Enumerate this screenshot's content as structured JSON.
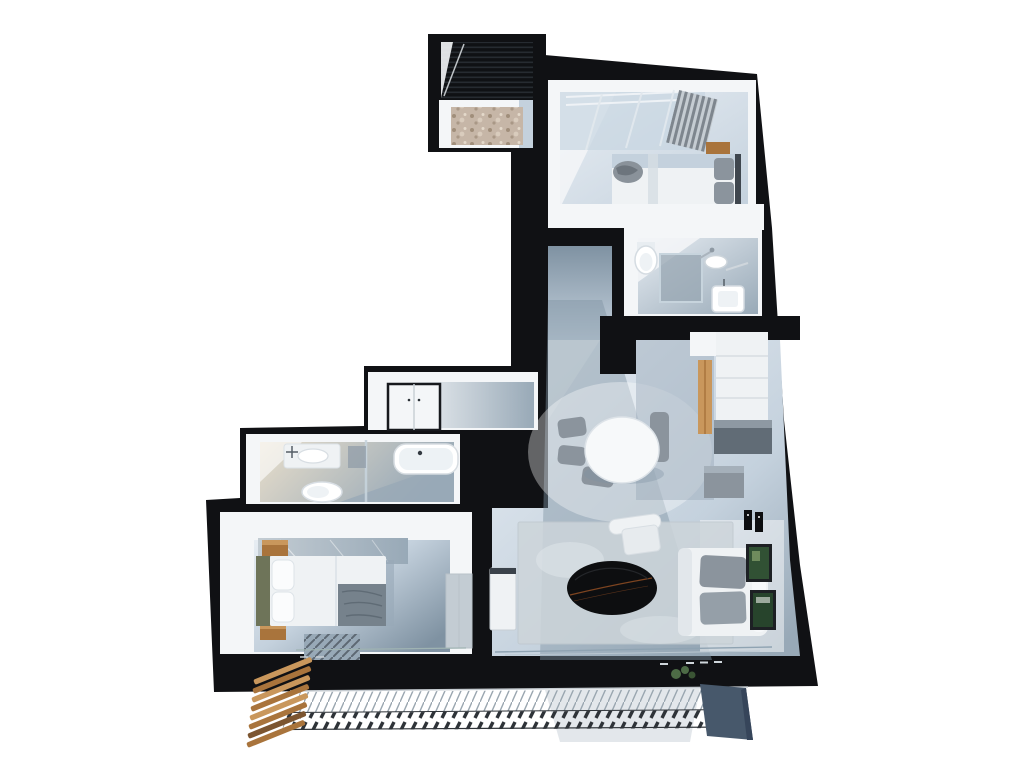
{
  "scene": {
    "type": "3d-floor-plan-render",
    "view": "top-down-isometric-apartment",
    "background": "#ffffff"
  },
  "colors": {
    "page": "#ffffff",
    "wall": "#101114",
    "wall_face": "#f4f6f8",
    "floor_light": "#e7edf3",
    "floor_mid": "#c4d1dd",
    "floor_gray": "#98a9b7",
    "floor_shadow": "#7f92a2",
    "closet_blue": "#c7d5e1",
    "beige": "#e8decb",
    "pebble": "#c6b6a7",
    "pebble_dark": "#96846f",
    "wood": "#a9743c",
    "wood_light": "#c9975c",
    "wood_dark": "#7c5530",
    "olive": "#6e7459",
    "marble": "#c3ccd3",
    "furn_white": "#eff2f4",
    "furn_gray": "#8b949d",
    "furn_dark": "#616c76",
    "bed_blanket": "#76828c",
    "table_black": "#0d0e10",
    "table_streak": "#8a4a22",
    "curtain_dark": "#7e868e",
    "curtain_light": "#c5ccd2",
    "rug": "#cdd5da",
    "rug_stripe": "#5d6873",
    "frame_dark": "#1d2024",
    "frame_green": "#315134",
    "frame_green2": "#27442c",
    "glass": "#c7d4dd",
    "slate": "#47586b",
    "plant": "#4d6b46",
    "hatch_light": "#9aa6b0",
    "hatch_dark": "#2e3338",
    "roof_base": "#0f1114",
    "roof_line": "#262b31"
  },
  "rooms": [
    {
      "id": "entry-porch"
    },
    {
      "id": "bedroom-top"
    },
    {
      "id": "bathroom-top"
    },
    {
      "id": "hallway"
    },
    {
      "id": "kitchen-dining"
    },
    {
      "id": "living-room"
    },
    {
      "id": "storage-room"
    },
    {
      "id": "bathroom-left"
    },
    {
      "id": "bedroom-left"
    },
    {
      "id": "terrace"
    }
  ],
  "furniture": [
    {
      "id": "double-bed-top"
    },
    {
      "id": "nightstand-top"
    },
    {
      "id": "curtain"
    },
    {
      "id": "closet-rails"
    },
    {
      "id": "toilet-top"
    },
    {
      "id": "shower-top"
    },
    {
      "id": "sink-top"
    },
    {
      "id": "kitchen-counter"
    },
    {
      "id": "kitchen-appliances"
    },
    {
      "id": "dining-table"
    },
    {
      "id": "dining-chairs"
    },
    {
      "id": "armchair"
    },
    {
      "id": "coffee-table"
    },
    {
      "id": "sofa"
    },
    {
      "id": "wall-frames"
    },
    {
      "id": "sideboard"
    },
    {
      "id": "storage-cabinet"
    },
    {
      "id": "sink-left"
    },
    {
      "id": "toilet-left"
    },
    {
      "id": "bathtub"
    },
    {
      "id": "double-bed-left"
    },
    {
      "id": "wardrobe"
    },
    {
      "id": "bedroom-rug"
    },
    {
      "id": "living-rug"
    },
    {
      "id": "terrace-railing"
    },
    {
      "id": "wood-slats"
    },
    {
      "id": "terrace-post"
    }
  ]
}
